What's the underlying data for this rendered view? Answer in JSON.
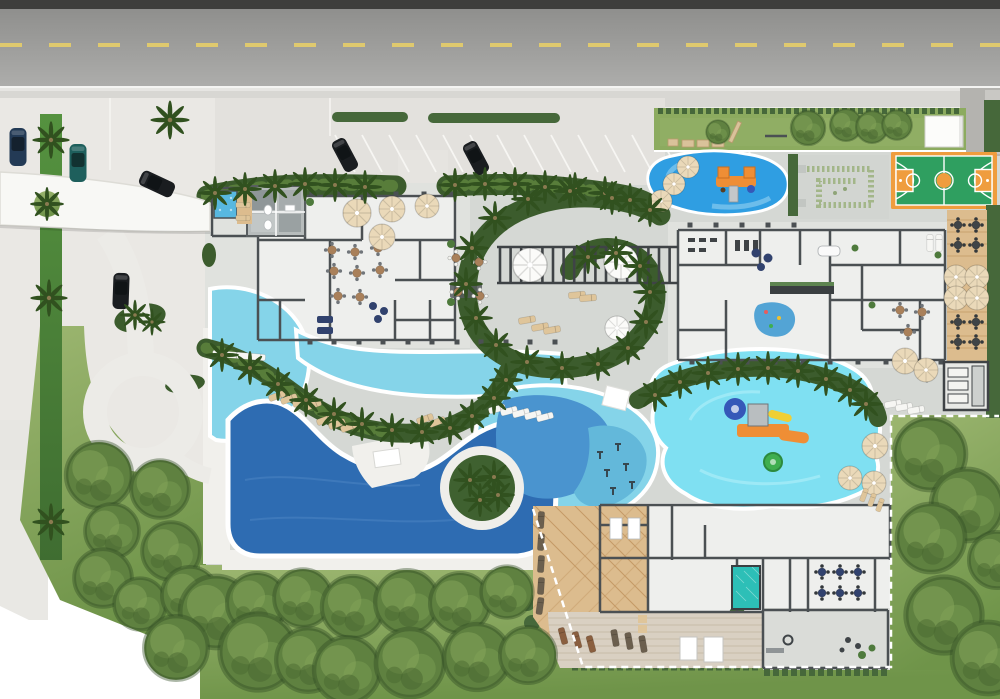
{
  "scene": {
    "type": "architectural-site-plan",
    "width": 1000,
    "height": 699
  },
  "palette": {
    "page": "#ffffff",
    "asphalt_dark": "#3e3e3c",
    "asphalt": "#a6a6a4",
    "lane": "#dfc96e",
    "edge_line": "#f4f4f2",
    "sidewalk": "#d8d7d3",
    "paver": "#eae8e4",
    "paver2": "#e3e1dd",
    "plaza": "#d5d8d4",
    "drive": "#b4b3af",
    "canopy": "#f8f8f5",
    "lawn": "#85a75c",
    "lawn_strip": "#8cab5f",
    "tree": "#5f8140",
    "palm": "#3c5c2d",
    "palm_dark": "#31511f",
    "hedge": "#46683a",
    "hedge_bright": "#4f8c3d",
    "pool_light": "#85d4e9",
    "pool_mid": "#4a94cf",
    "pool_aqua": "#63b8da",
    "pool_dark": "#2e6cb2",
    "kidpool": "#7fe0f2",
    "splash": "#2f9ee2",
    "plunge": "#2dbfb7",
    "jacuzzi": "#58b8e0",
    "court_green": "#2f9f60",
    "court_orange": "#ef9d3e",
    "deck_wood": "#dcbc8e",
    "plank": "#d9d0c2",
    "terrace": "#e0e2de",
    "floor": "#eeefed",
    "wall": "#4b5053",
    "white_deck": "#f1f0ec",
    "umb_tan": "#ead9b9",
    "umb_white": "#fbfbf9",
    "furn_dark": "#3f4447",
    "furn_navy": "#31426e",
    "furn_brown": "#a9805a",
    "lounger_white": "#f6f6f3",
    "lounger_tan": "#dfc59a",
    "lounger_dark": "#6b5f4e",
    "lounger_brown": "#8a5f3f",
    "car_navy": "#233a55",
    "car_teal": "#1e5f5c",
    "car_black": "#1a1d20",
    "shed": "#fcfcfa",
    "boundary": "#ffffff",
    "slide_orange": "#ef8e35",
    "slide_blue": "#3558b8",
    "slide_yellow": "#f0cf35",
    "splash_ring_green": "#3fae4f"
  },
  "features": {
    "road": {
      "label": "Access avenue with dashed lane line"
    },
    "street_parking": {
      "label": "Street-side parallel parking"
    },
    "parking_bays": {
      "label": "Angled visitor parking bays"
    },
    "entrance_canopy": {
      "label": "Entrance drop-off canopy"
    },
    "drop_off_loop": {
      "label": "Drop-off loop drive"
    },
    "hedge_strip": {
      "label": "Hedge planting strip with palms"
    },
    "fitness_lawn": {
      "label": "Outdoor fitness lawn"
    },
    "service_shed": {
      "label": "Service shed"
    },
    "basketball_court": {
      "label": "Basketball court"
    },
    "hedge_garden": {
      "label": "Formal hedge garden"
    },
    "splash_pad": {
      "label": "Kids splash pad with play tower"
    },
    "clubhouse": {
      "label": "Clubhouse with restaurant and lounge"
    },
    "jacuzzi": {
      "label": "Rooftop jacuzzi"
    },
    "umbrella_terrace": {
      "label": "Umbrella terrace"
    },
    "pergola_plaza": {
      "label": "Pergola lounge plaza"
    },
    "palm_spiral": {
      "label": "Spiral palm walk"
    },
    "palm_walk": {
      "label": "Serpentine palm walk"
    },
    "lagoon_pool": {
      "label": "Lagoon leisure pool"
    },
    "beach_entry": {
      "label": "Beach-entry shallows with in-water loungers"
    },
    "lap_pool": {
      "label": "Deep-water lap pool"
    },
    "palm_island": {
      "label": "Palm island with deck ring"
    },
    "leisure_pool": {
      "label": "Rounded leisure pool"
    },
    "aqua_gym": {
      "label": "Aqua-gym pool zone"
    },
    "waterpark_pool": {
      "label": "Kids waterpark pool"
    },
    "water_playground": {
      "label": "Water playground with slides"
    },
    "amenities_building": {
      "label": "Amenities pavilion with gym and kids club"
    },
    "dining_deck": {
      "label": "Wood deck dining terrace"
    },
    "garden_pergola": {
      "label": "Garden pergola structure"
    },
    "spa_building": {
      "label": "Spa and wellness pavilion"
    },
    "wood_deck": {
      "label": "Spa sun deck"
    },
    "plunge_pool": {
      "label": "Plunge pool"
    },
    "massage_cabanas": {
      "label": "Massage cabanas"
    },
    "event_patio": {
      "label": "Event patio with fire pit"
    },
    "orchard_lawn": {
      "label": "Orchard lawn with canopy trees"
    },
    "side_lawn": {
      "label": "East lawn inside dashed boundary"
    },
    "property_boundary": {
      "label": "Dashed property boundary"
    },
    "parked_cars": {
      "label": "Parked cars"
    }
  }
}
